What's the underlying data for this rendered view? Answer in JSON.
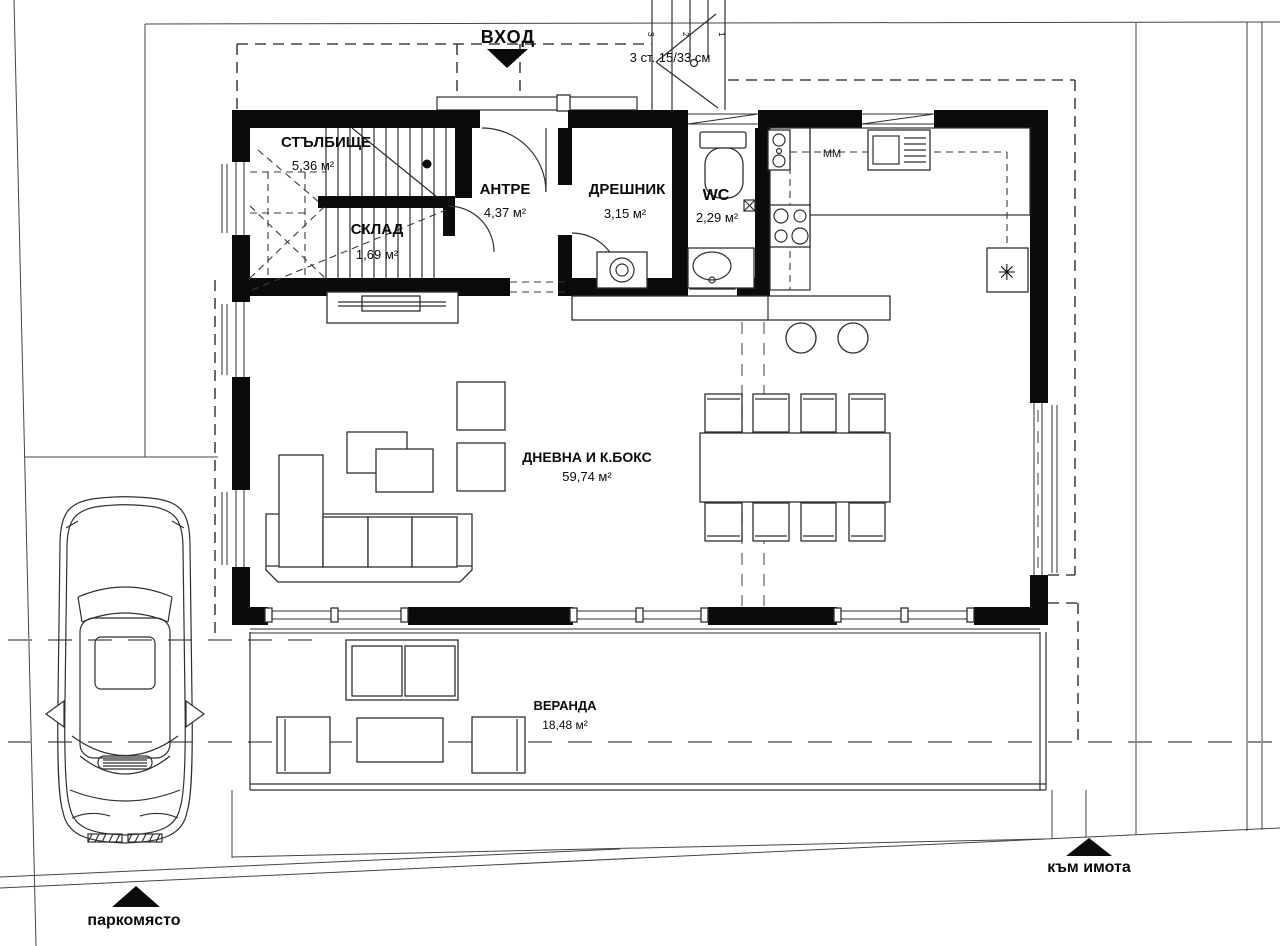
{
  "drawing": {
    "type": "architectural ground-floor plan with site",
    "labels": {
      "entrance": "ВХОД",
      "steps_note": "3 ст. 15/33 см",
      "step_digits": [
        "3",
        "2",
        "1"
      ],
      "appliance_mm": "ММ",
      "fridge_symbol": "✳",
      "parking": "паркомясто",
      "to_property": "към имота"
    },
    "rooms": [
      {
        "id": "staircase",
        "name": "СТЪЛБИЩЕ",
        "area": "5,36 м²"
      },
      {
        "id": "storage",
        "name": "СКЛАД",
        "area": "1,69 м²"
      },
      {
        "id": "hallway",
        "name": "АНТРЕ",
        "area": "4,37 м²"
      },
      {
        "id": "closet",
        "name": "ДРЕШНИК",
        "area": "3,15 м²"
      },
      {
        "id": "wc",
        "name": "WC",
        "area": "2,29 м²"
      },
      {
        "id": "living",
        "name": "ДНЕВНА И К.БОКС",
        "area": "59,74 м²"
      },
      {
        "id": "veranda",
        "name": "ВЕРАНДА",
        "area": "18,48 м²"
      }
    ],
    "colors": {
      "walls": "#0b0b0b",
      "lines": "#2f2f2f",
      "dashed_gray": "#8c8c8c",
      "background": "#ffffff"
    }
  }
}
